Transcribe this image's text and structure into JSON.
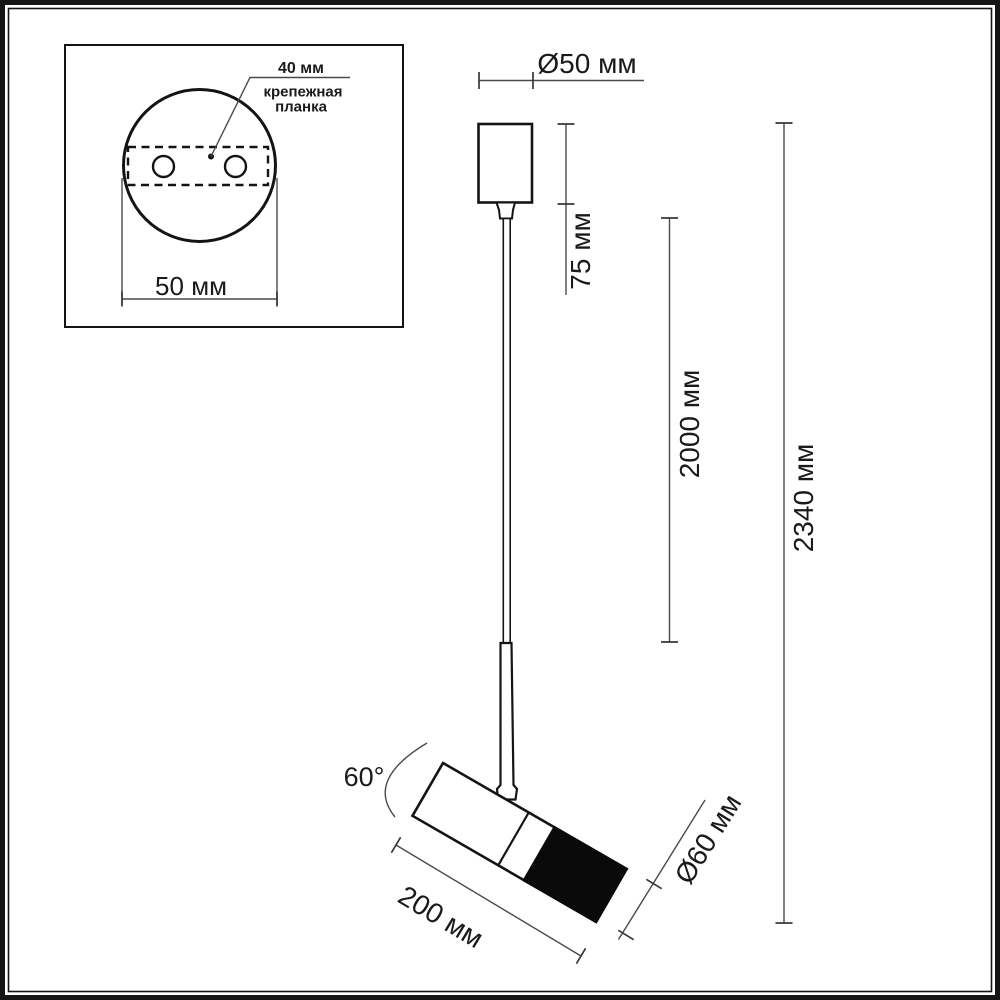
{
  "page": {
    "title": "Pendant spotlight dimension drawing"
  },
  "colors": {
    "outline": "#141414",
    "dimension_line": "#4a4a4a",
    "text": "#1a1a1a",
    "background": "#ffffff",
    "head_front_fill": "#0a0a0a"
  },
  "inset": {
    "hole_spacing_label": "40 мм",
    "plate_label_line1": "крепежная",
    "plate_label_line2": "планка",
    "base_diameter_label": "50 мм"
  },
  "dimensions": {
    "canopy_diameter": "Ø50 мм",
    "canopy_height": "75 мм",
    "cable_length": "2000 мм",
    "overall_height": "2340 мм",
    "tilt_angle": "60°",
    "head_length": "200 мм",
    "head_diameter": "Ø60 мм"
  }
}
